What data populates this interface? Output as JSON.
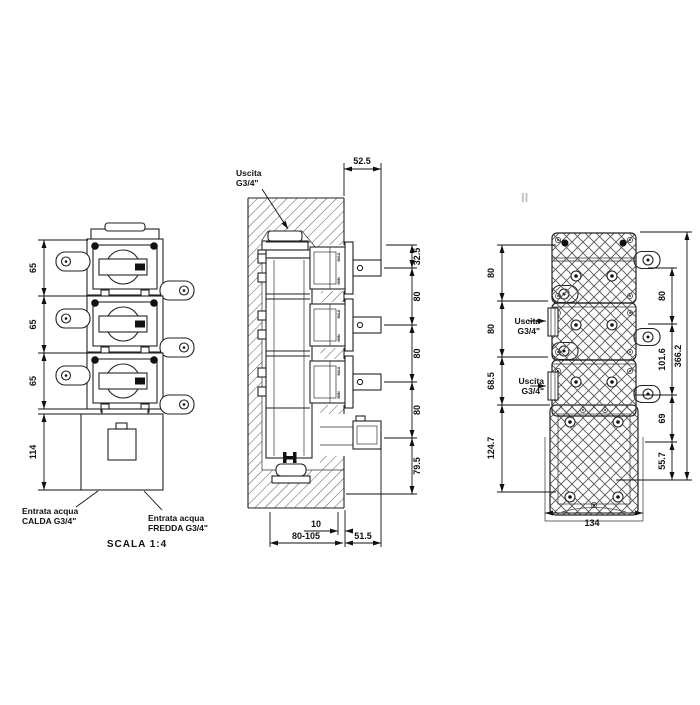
{
  "watermark": "II",
  "front_view": {
    "dims": {
      "pitch1": "65",
      "pitch2": "65",
      "pitch3": "65",
      "box_height": "114"
    },
    "hot_inlet": {
      "line1": "Entrata acqua",
      "line2": "CALDA G3/4\""
    },
    "cold_inlet": {
      "line1": "Entrata acqua",
      "line2": "FREDDA G3/4\""
    },
    "scale_note": "SCALA 1:4"
  },
  "section_view": {
    "outlet": {
      "line1": "Uscita",
      "line2": "G3/4\""
    },
    "dims": {
      "protrusion": "52.5",
      "top": "32.5",
      "pitch1": "80",
      "pitch2": "80",
      "pitch3": "80",
      "bottom": "79.5",
      "plaster": "10",
      "depth_range": "80-105",
      "stub": "51.5"
    },
    "markings": {
      "max": "MAX",
      "min": "MIN"
    }
  },
  "face_view": {
    "outlet_upper": {
      "line1": "Uscita",
      "line2": "G3/4\""
    },
    "outlet_lower": {
      "line1": "Uscita",
      "line2": "G3/4\""
    },
    "dims": {
      "left_pitch1": "80",
      "left_pitch2": "80",
      "left_offset": "68.5",
      "left_box": "124.7",
      "right_pitch": "80",
      "right_mid": "101.6",
      "right_low": "69",
      "right_bottom": "55.7",
      "overall": "366.2",
      "width": "134"
    }
  }
}
